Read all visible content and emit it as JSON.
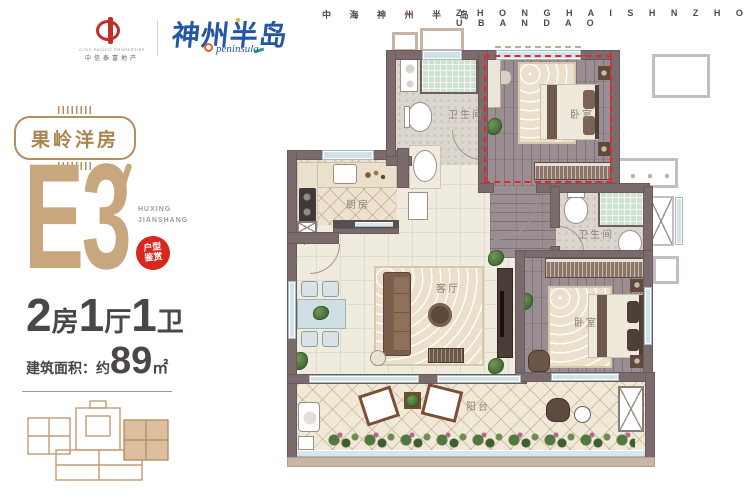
{
  "header": {
    "company_en": "CITIC PACIFIC PROPERTIES",
    "company_cn": "中信泰富地产",
    "brand_cn": "神州半岛",
    "brand_en": "peninsula",
    "site_cn": "中 海 神 州 半 岛",
    "site_en": "Z H O N G H A I S H N Z H O U B A N D A O"
  },
  "panel": {
    "badge_label": "果岭洋房",
    "unit_code": "E3",
    "sub_en_1": "HUXING",
    "sub_en_2": "JIANSHANG",
    "seal_top": "户型",
    "seal_bottom": "鉴赏",
    "layout": [
      {
        "num": "2",
        "unit": "房"
      },
      {
        "num": "1",
        "unit": "厅"
      },
      {
        "num": "1",
        "unit": "卫"
      }
    ],
    "area_prefix": "建筑面积：",
    "area_approx": "约",
    "area_number": "89",
    "area_unit": "㎡"
  },
  "plan": {
    "labels": {
      "bathroom1": "卫生间",
      "bathroom2": "卫生间",
      "kitchen": "厨房",
      "living": "客厅",
      "bedroom1": "卧室",
      "bedroom2": "卧室",
      "balcony": "阳台"
    }
  },
  "colors": {
    "highlight_red": "#e8262a",
    "seal_red": "#d8281e",
    "gold": "#b28f60",
    "unit_code_tan": "#c8a67e",
    "text_dark": "#4b4749",
    "wall": "#7c6b6d",
    "brand_blue": "#2456a8"
  }
}
